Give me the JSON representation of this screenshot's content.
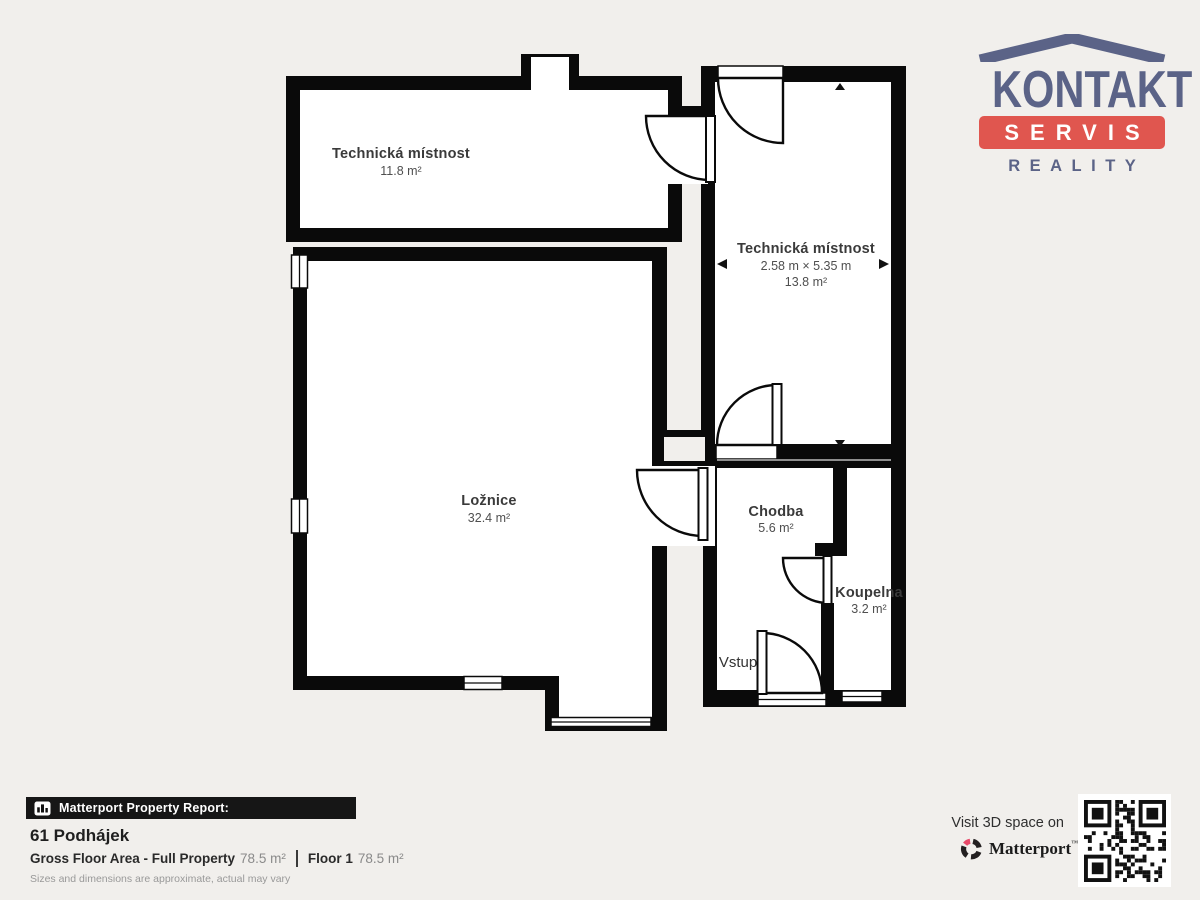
{
  "plan": {
    "rooms": [
      {
        "name": "Technická místnost",
        "area": "11.8 m²"
      },
      {
        "name": "Technická místnost",
        "dims": "2.58 m × 5.35 m",
        "area": "13.8 m²"
      },
      {
        "name": "Ložnice",
        "area": "32.4 m²"
      },
      {
        "name": "Chodba",
        "area": "5.6 m²"
      },
      {
        "name": "Koupelna",
        "area": "3.2 m²"
      }
    ],
    "entry_label": "Vstup",
    "wall_color": "#0a0a0a",
    "room_fill": "#ffffff",
    "background_color": "#f1efec"
  },
  "logo": {
    "title": "KONTAKT",
    "subtitle": "SERVIS",
    "tagline": "REALITY",
    "blue": "#5b6387",
    "red": "#e0564f"
  },
  "report": {
    "bar_label": "Matterport Property Report:",
    "address": "61 Podhájek",
    "gross_label": "Gross Floor Area - Full Property",
    "gross_value": "78.5 m²",
    "floor_label": "Floor 1",
    "floor_value": "78.5 m²",
    "disclaimer": "Sizes and dimensions are approximate, actual may vary"
  },
  "cta": {
    "visit_text": "Visit 3D space on",
    "brand": "Matterport",
    "trademark": "™",
    "brand_pink": "#e84a6a",
    "brand_black": "#231f20"
  }
}
